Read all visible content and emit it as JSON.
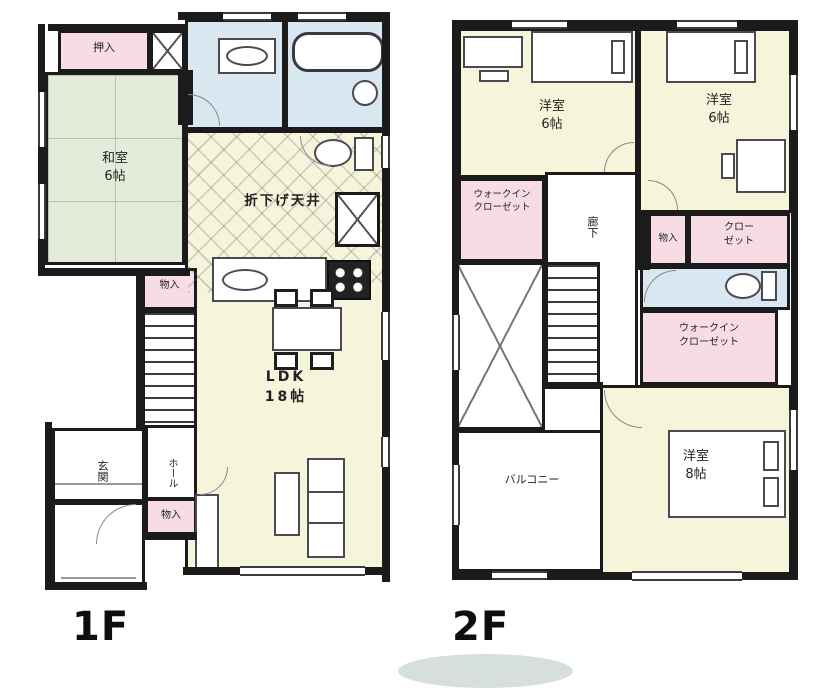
{
  "floor1": {
    "caption": "1F",
    "rooms": {
      "oshiire": "押入",
      "washitsu": "和室\n6帖",
      "orisage_ceiling": "折下げ天井",
      "ldk": "LDK\n18帖",
      "storage_stairs": "物入",
      "genkan": "玄関",
      "hall": "ホール",
      "storage_hall": "物入"
    }
  },
  "floor2": {
    "caption": "2F",
    "rooms": {
      "bedroom_nw": "洋室\n6帖",
      "bedroom_ne": "洋室\n6帖",
      "wic_west": "ウォークイン\nクローゼット",
      "hallway": "廊下",
      "storage": "物入",
      "closet": "クロー\nゼット",
      "wic_east": "ウォークイン\nクローゼット",
      "balcony": "バルコニー",
      "bedroom_south": "洋室\n8帖"
    }
  },
  "colors": {
    "wall": "#1b1b1b",
    "tatami_room": "#e3ecda",
    "wet_area": "#d9e7f1",
    "storage_pink": "#f7dce6",
    "living_cream": "#f7f4dc"
  }
}
